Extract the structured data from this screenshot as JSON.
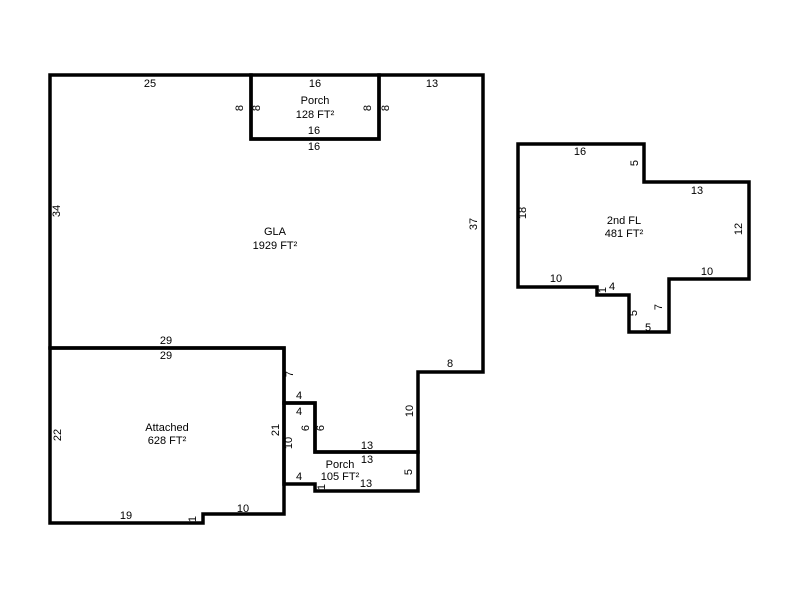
{
  "plan": {
    "background": "#ffffff",
    "line_color": "#000000",
    "text_color": "#000000",
    "shapes": {
      "gla": {
        "label": "GLA",
        "area": "1929 FT²",
        "dims": [
          "25",
          "13",
          "8",
          "8",
          "16",
          "34",
          "37",
          "29",
          "8",
          "7",
          "4",
          "10",
          "6",
          "13"
        ]
      },
      "front_porch": {
        "label": "Porch",
        "area": "128 FT²",
        "dims": [
          "16",
          "8",
          "8",
          "16"
        ]
      },
      "rear_porch": {
        "label": "Porch",
        "area": "105 FT²",
        "dims": [
          "4",
          "6",
          "13",
          "10",
          "5",
          "13",
          "1",
          "4"
        ]
      },
      "attached_garage": {
        "label": "Attached",
        "area": "628 FT²",
        "dims": [
          "29",
          "22",
          "21",
          "19",
          "1",
          "10"
        ]
      },
      "second_floor": {
        "label": "2nd FL",
        "area": "481 FT²",
        "dims": [
          "16",
          "5",
          "13",
          "18",
          "12",
          "10",
          "1",
          "4",
          "10",
          "7",
          "5",
          "5"
        ]
      }
    }
  }
}
